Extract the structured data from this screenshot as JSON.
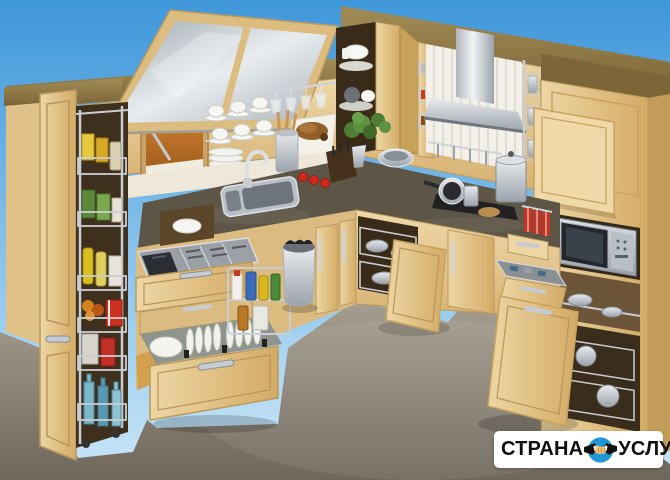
{
  "image_description": "Showroom photo of an L-shaped beech kitchen with all cabinets, drawers and pull-out storage open (pantry baskets, cutlery drawer, plate drawer, carousel corner unit, spice racks, microwave column), sky-blue backdrop and grey floor",
  "watermark": {
    "left": "СТРАНА",
    "right": "УСЛУГ",
    "icon": "handshake-icon"
  },
  "colors": {
    "sky_top": "#3f97da",
    "sky_bottom": "#bfe2f6",
    "floor_light": "#a69e90",
    "floor_dark": "#6f675b",
    "wood_light": "#eed6a4",
    "wood_mid": "#dcbb80",
    "wood_dark": "#c49c5a",
    "cornice": "#94804e",
    "counter_top": "#5d5546",
    "counter_edge": "#39342b",
    "steel": "#c7ccd2",
    "backsplash": "#efe8d8",
    "interior_dark": "#3a2b18",
    "interior_orange": "#c9742f",
    "plant_green": "#4e7d35",
    "tomato_red": "#d6271c",
    "towel_red": "#c33326",
    "badge_bg": "#ffffff",
    "badge_blue": "#1f97d4",
    "badge_text": "#101010",
    "hand_tan": "#f0c277"
  }
}
